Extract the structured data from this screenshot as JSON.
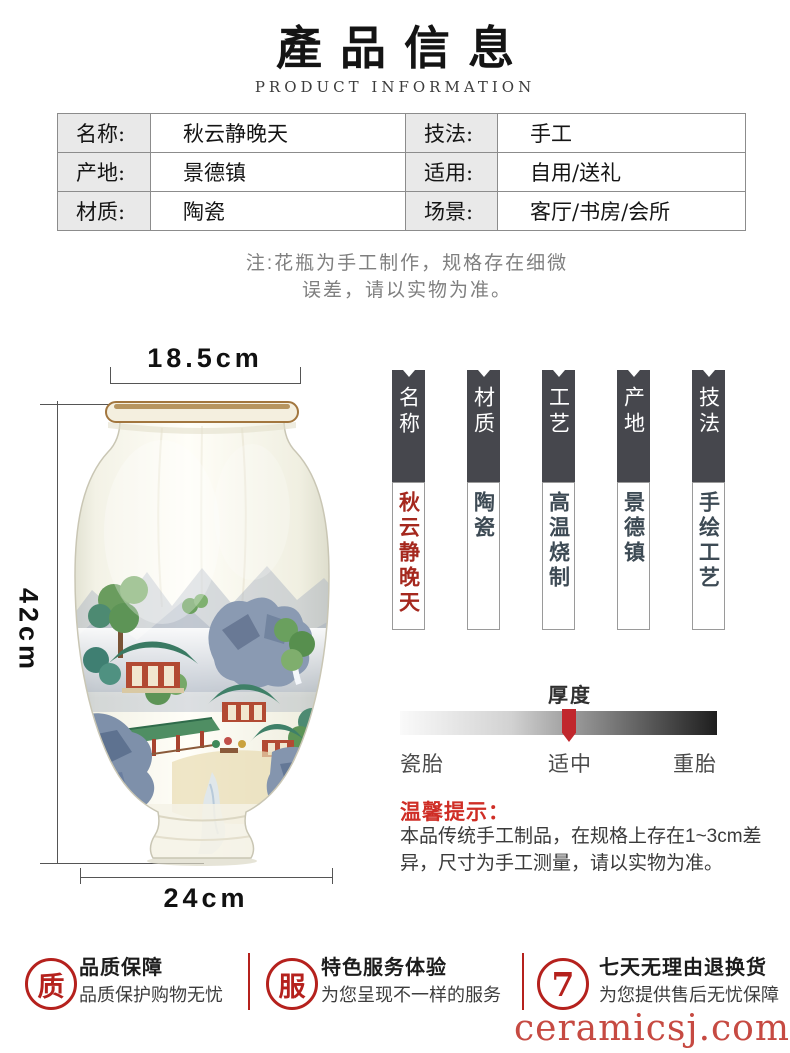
{
  "header": {
    "title": "產品信息",
    "subtitle": "PRODUCT INFORMATION"
  },
  "spec_table": {
    "rows": [
      {
        "label1": "名称:",
        "value1": "秋云静晚天",
        "label2": "技法:",
        "value2": "手工"
      },
      {
        "label1": "产地:",
        "value1": "景德镇",
        "label2": "适用:",
        "value2": "自用/送礼"
      },
      {
        "label1": "材质:",
        "value1": "陶瓷",
        "label2": "场景:",
        "value2": "客厅/书房/会所"
      }
    ]
  },
  "note": {
    "line1": "注:花瓶为手工制作，规格存在细微",
    "line2": "误差，请以实物为准。"
  },
  "dimensions": {
    "top_width": "18.5cm",
    "height": "42cm",
    "bottom_width": "24cm"
  },
  "banners": [
    {
      "header": "名称",
      "body": "秋云静晚天"
    },
    {
      "header": "材质",
      "body": "陶瓷"
    },
    {
      "header": "工艺",
      "body": "高温烧制"
    },
    {
      "header": "产地",
      "body": "景德镇"
    },
    {
      "header": "技法",
      "body": "手绘工艺"
    }
  ],
  "thickness": {
    "title": "厚度",
    "left_label": "瓷胎",
    "center_label": "适中",
    "right_label": "重胎"
  },
  "tips": {
    "title": "温馨提示：",
    "line1": "本品传统手工制品，在规格上存在1~3cm差",
    "line2": "异，尺寸为手工测量，请以实物为准。"
  },
  "services": [
    {
      "icon": "质",
      "title": "品质保障",
      "subtitle": "品质保护购物无忧"
    },
    {
      "icon": "服",
      "title": "特色服务体验",
      "subtitle": "为您呈现不一样的服务"
    },
    {
      "icon": "7",
      "title": "七天无理由退换货",
      "subtitle": "为您提供售后无忧保障"
    }
  ],
  "watermark": "ceramicsj.com",
  "colors": {
    "accent_red": "#b5211d",
    "accent_red_dark": "#a5281e",
    "banner_dark": "#46474d",
    "line_gray": "#8c8c8c"
  }
}
